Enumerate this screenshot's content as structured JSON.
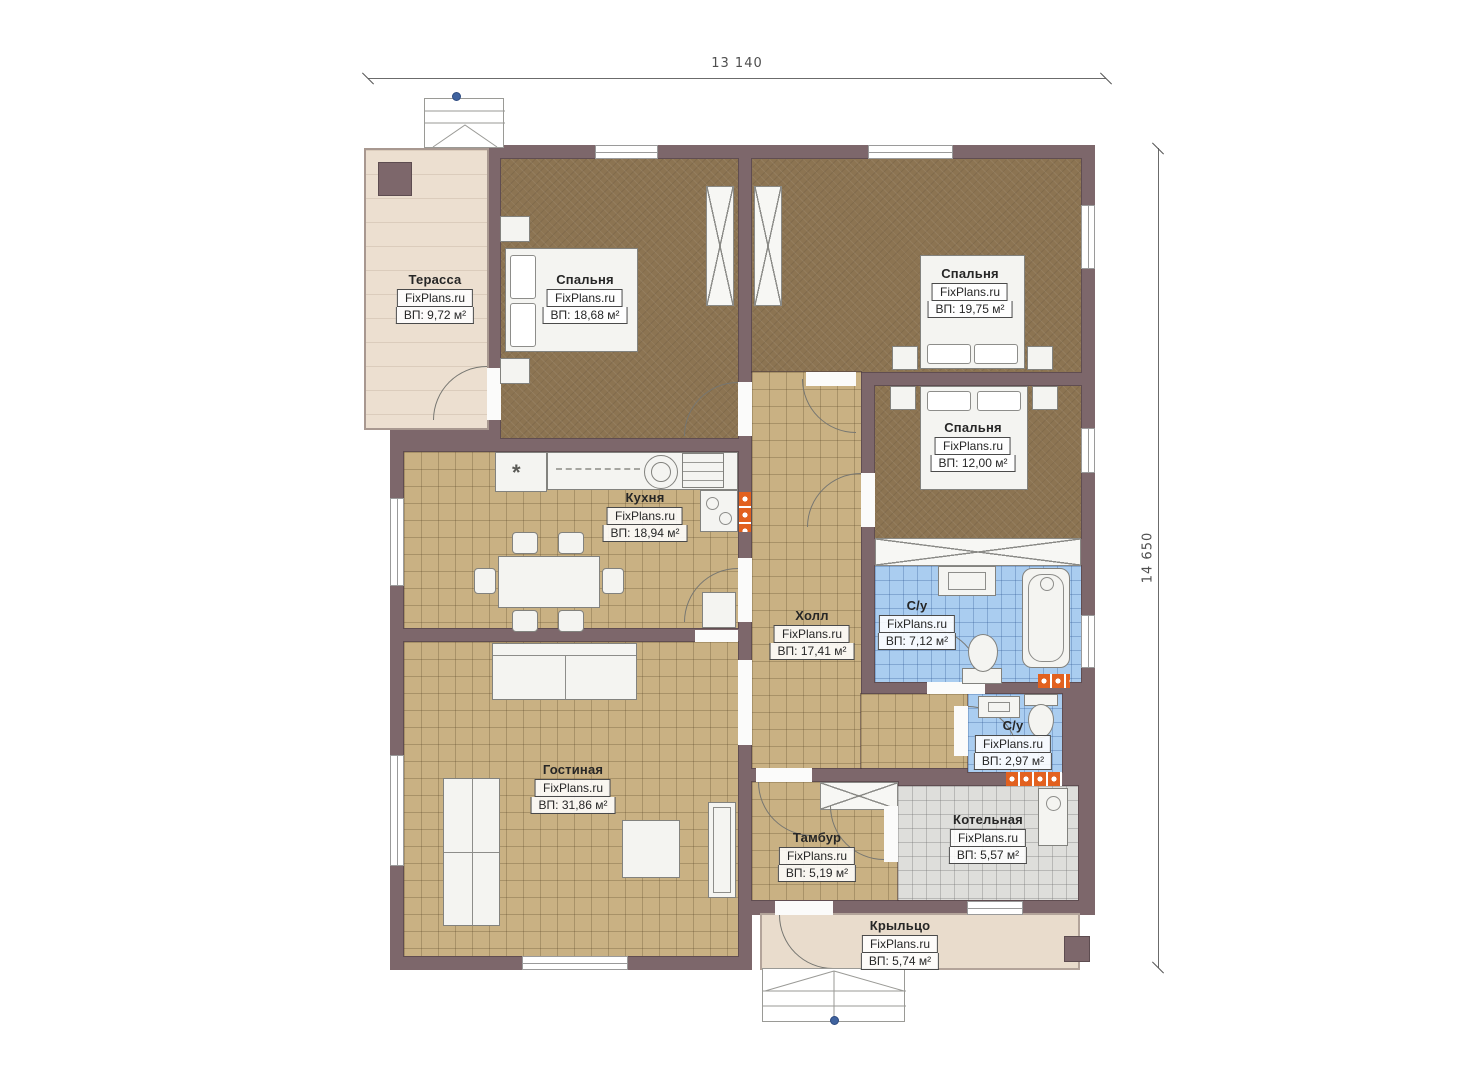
{
  "dimensions": {
    "width": "13 140",
    "height": "14 650"
  },
  "watermark": "FixPlans.ru",
  "rooms": [
    {
      "name": "Терасса",
      "area": "ВП: 9,72 м²"
    },
    {
      "name": "Спальня",
      "area": "ВП: 18,68 м²"
    },
    {
      "name": "Спальня",
      "area": "ВП: 19,75 м²"
    },
    {
      "name": "Спальня",
      "area": "ВП: 12,00 м²"
    },
    {
      "name": "Кухня",
      "area": "ВП: 18,94 м²"
    },
    {
      "name": "Холл",
      "area": "ВП: 17,41 м²"
    },
    {
      "name": "С/у",
      "area": "ВП: 7,12 м²"
    },
    {
      "name": "С/у",
      "area": "ВП: 2,97 м²"
    },
    {
      "name": "Гостиная",
      "area": "ВП: 31,86 м²"
    },
    {
      "name": "Тамбур",
      "area": "ВП: 5,19 м²"
    },
    {
      "name": "Котельная",
      "area": "ВП: 5,57 м²"
    },
    {
      "name": "Крыльцо",
      "area": "ВП: 5,74 м²"
    }
  ],
  "symbols": {
    "kitchen_asterisk": "*"
  },
  "colors": {
    "wall": "#7d676b",
    "bedroom_floor": "#8c7452",
    "tile_floor": "#c9b183",
    "bath_floor": "#aacdf0",
    "boiler_floor": "#dededb",
    "terrace_floor": "#ecdfd0",
    "radiator": "#e2611f"
  }
}
